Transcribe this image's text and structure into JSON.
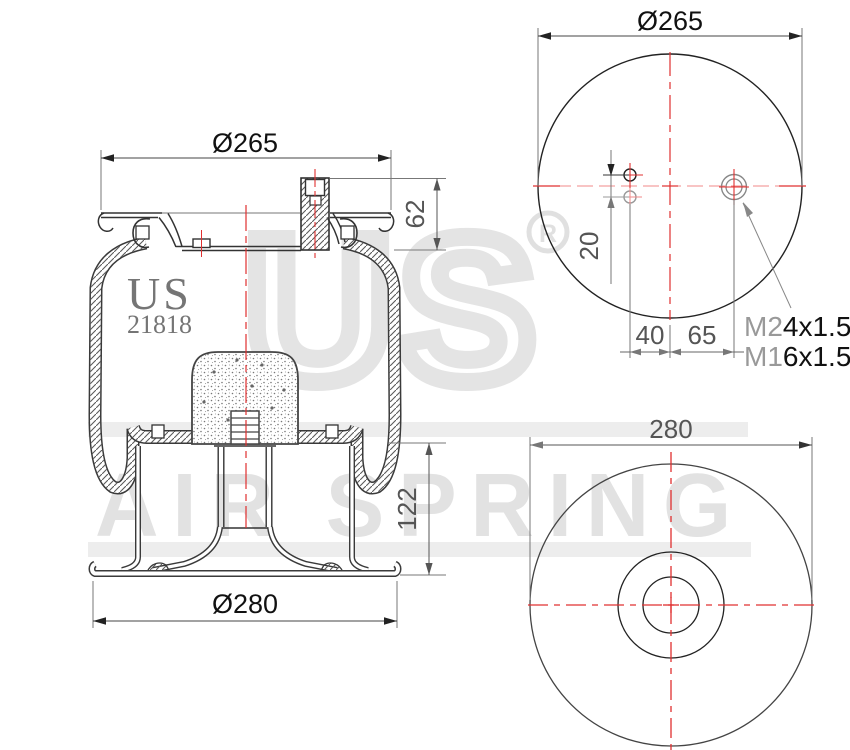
{
  "title": "Air spring technical drawing",
  "colors": {
    "centerline_red": "#e03030",
    "centerline_pink": "#f08a8a",
    "line_dark": "#333333",
    "dim_gray": "#555555",
    "watermark_gray": "#e3e3e3",
    "watermark_bar": "#ededed",
    "brand_gray": "#757575"
  },
  "branding": {
    "logo": "US",
    "part_number": "21818",
    "registered": "R",
    "watermark_word": "US",
    "watermark_text": "AIR SPRING"
  },
  "side_view": {
    "dim_plate_diameter": "Ø265",
    "dim_stud_height": "62",
    "dim_lower_section_height": "122",
    "dim_base_diameter": "Ø280"
  },
  "top_view": {
    "dim_plate_diameter": "Ø265",
    "dim_hole_spacing": "20",
    "dim_holes_offset": "40",
    "dim_stud_offset": "65",
    "stud_thread_prefix": "M2",
    "stud_thread_suffix": "4x1.5",
    "hole_thread_prefix": "M1",
    "hole_thread_suffix": "6x1.5"
  },
  "bottom_view": {
    "dim_base_diameter": "280"
  }
}
